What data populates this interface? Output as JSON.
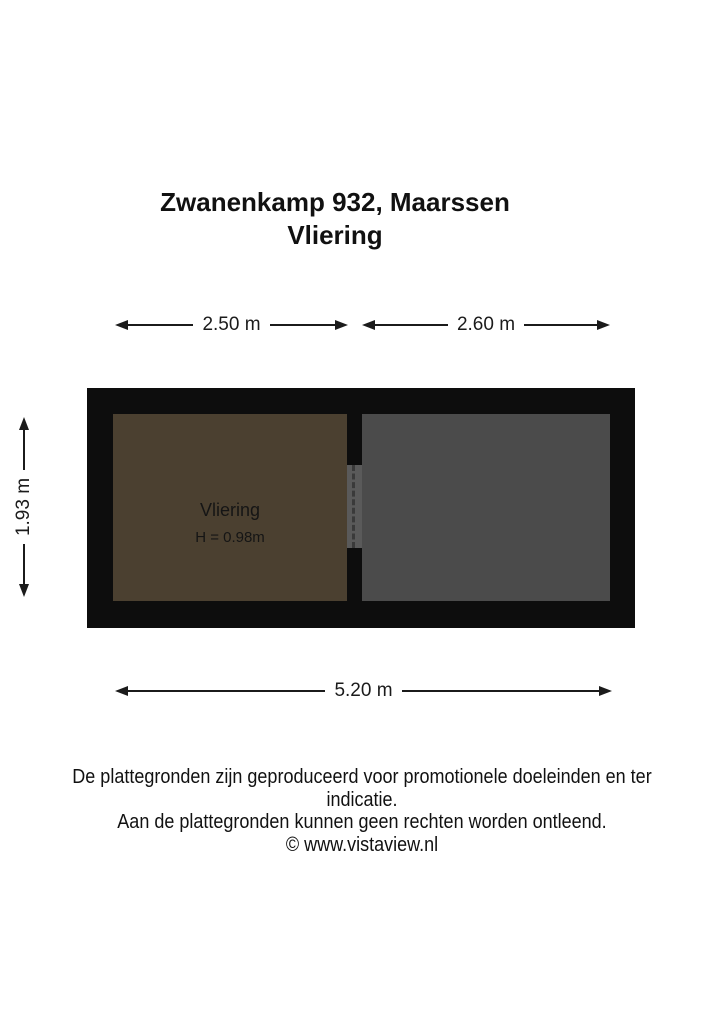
{
  "page": {
    "background": "#ffffff",
    "text_color": "#111111"
  },
  "title": {
    "line1": "Zwanenkamp 932, Maarssen",
    "line2": "Vliering"
  },
  "dimensions": {
    "top_left": "2.50 m",
    "top_right": "2.60 m",
    "left": "1.93 m",
    "bottom": "5.20 m"
  },
  "floorplan": {
    "wall_color": "#0d0d0d",
    "hatch_color": "#5a5a5a",
    "rooms": [
      {
        "id": "vliering",
        "label": "Vliering",
        "height_label": "H = 0.98m",
        "fill": "#4b4030"
      },
      {
        "id": "attic-right",
        "label": "",
        "height_label": "",
        "fill": "#4b4b4b"
      }
    ]
  },
  "footer": {
    "line1": "De plattegronden zijn geproduceerd voor promotionele doeleinden en ter indicatie.",
    "line2": "Aan de plattegronden kunnen geen rechten worden ontleend.",
    "line3": "© www.vistaview.nl"
  }
}
